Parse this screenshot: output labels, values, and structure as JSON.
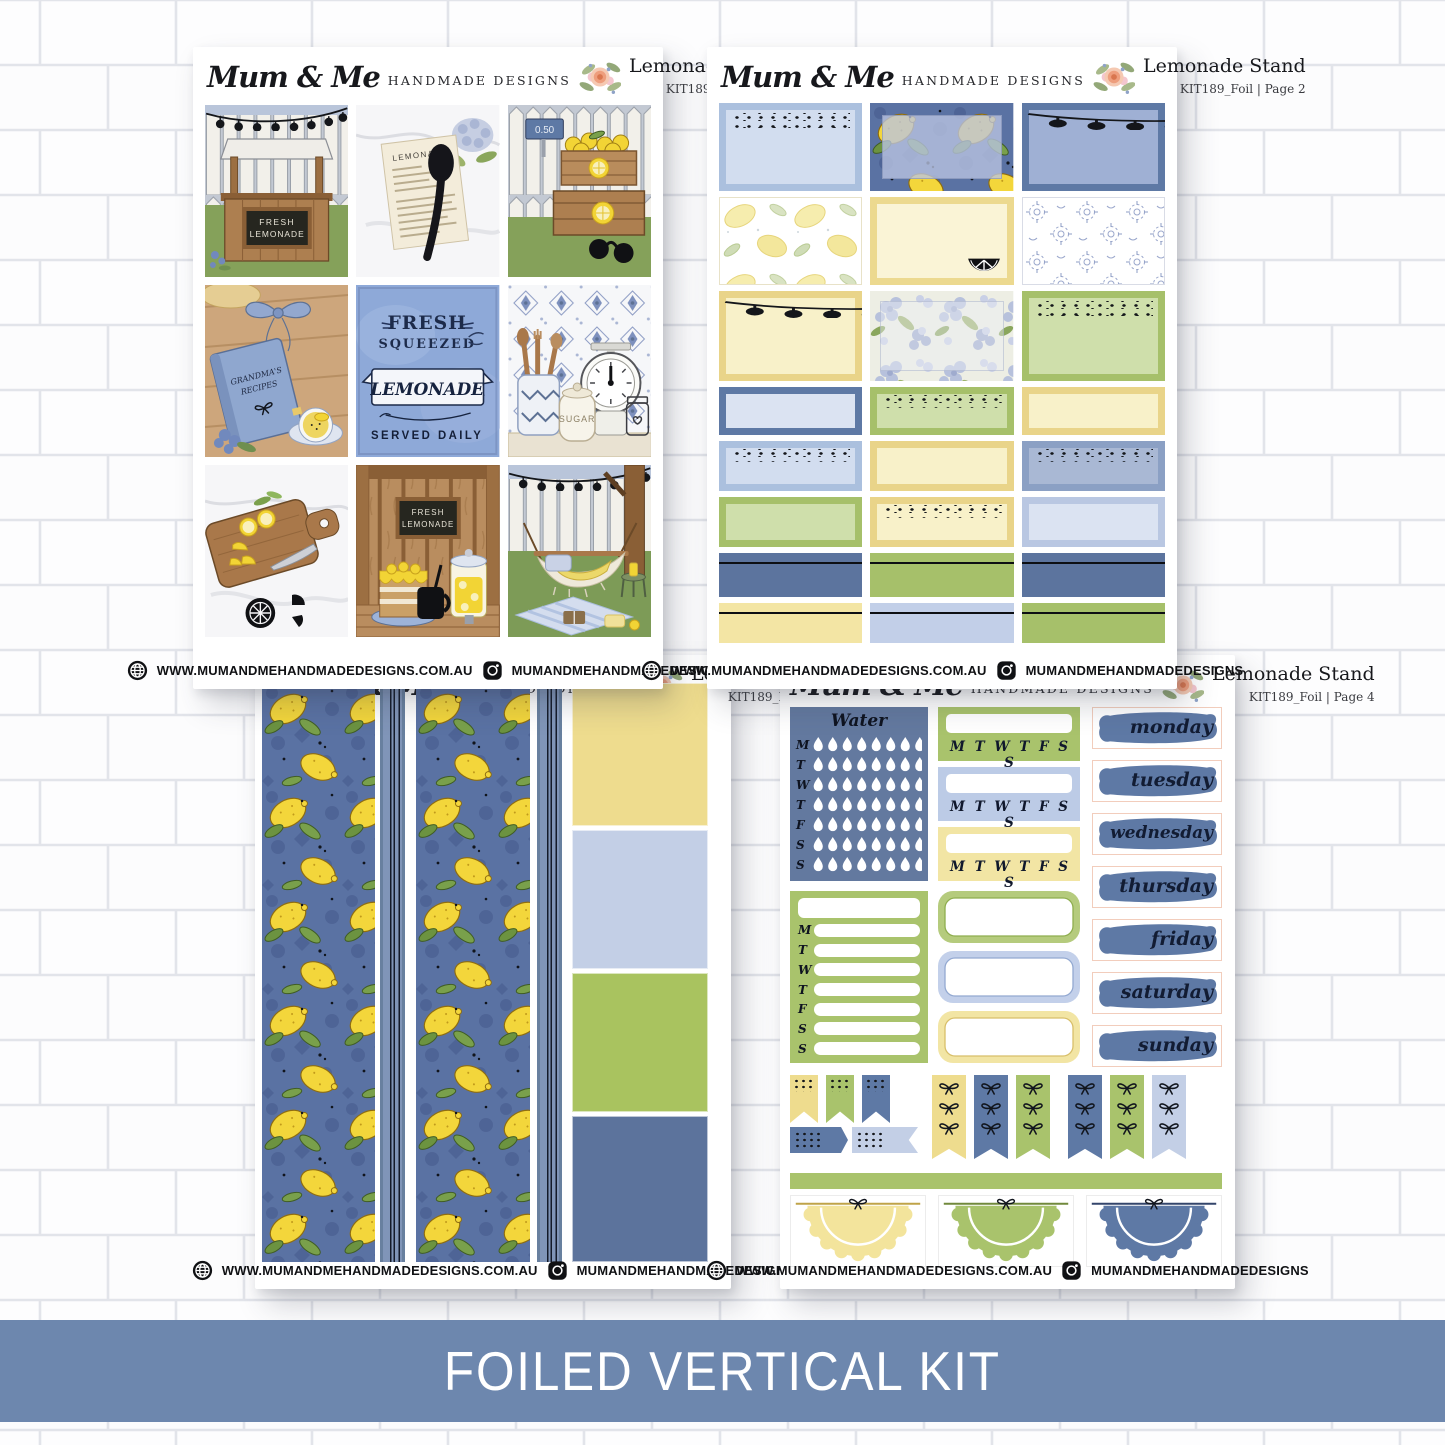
{
  "banner": {
    "label": "FOILED VERTICAL KIT",
    "color": "#6d87ae"
  },
  "brand": {
    "script": "Mum & Me",
    "caps": "HANDMADE DESIGNS",
    "website": "WWW.MUMANDMEHANDMADEDESIGNS.COM.AU",
    "instagram_handle": "MUMANDMEHANDMADEDESIGNS"
  },
  "kit": {
    "title": "Lemonade Stand",
    "code": "KIT189_Foil",
    "pages": {
      "p1": "KIT189_Foil | Page 1",
      "p2": "KIT189_Foil | Page 2",
      "p3": "KIT189_Foil | Page 3",
      "p4": "KIT189_Foil | Page 4"
    }
  },
  "palette": {
    "denim_blue": "#5e79a5",
    "banner_blue": "#6d87ae",
    "light_blue": "#c3cfe6",
    "pale_blue": "#dbe3f2",
    "green": "#a6c06a",
    "light_green": "#cfdfab",
    "yellow": "#eedc8e",
    "pale_yellow": "#f8f1c9",
    "lemon": "#f2d435",
    "foil_black": "#14161a"
  },
  "sheet1": {
    "stand_sign_line1": "FRESH",
    "stand_sign_line2": "LEMONADE",
    "recipe_title": "LEMONADE",
    "price_tag": "0.50",
    "book_line1": "GRANDMA'S",
    "book_line2": "RECIPES",
    "poster_line1": "FRESH",
    "poster_line2": "SQUEEZED",
    "poster_banner": "LEMONADE",
    "poster_line3": "SERVED DAILY",
    "jar_label": "SUGAR"
  },
  "sheet4": {
    "water_title": "Water",
    "week_letters": "M T W T F S S",
    "week_letters_list": [
      "M",
      "T",
      "W",
      "T",
      "F",
      "S",
      "S"
    ],
    "days": [
      "monday",
      "tuesday",
      "wednesday",
      "thursday",
      "friday",
      "saturday",
      "sunday"
    ]
  }
}
